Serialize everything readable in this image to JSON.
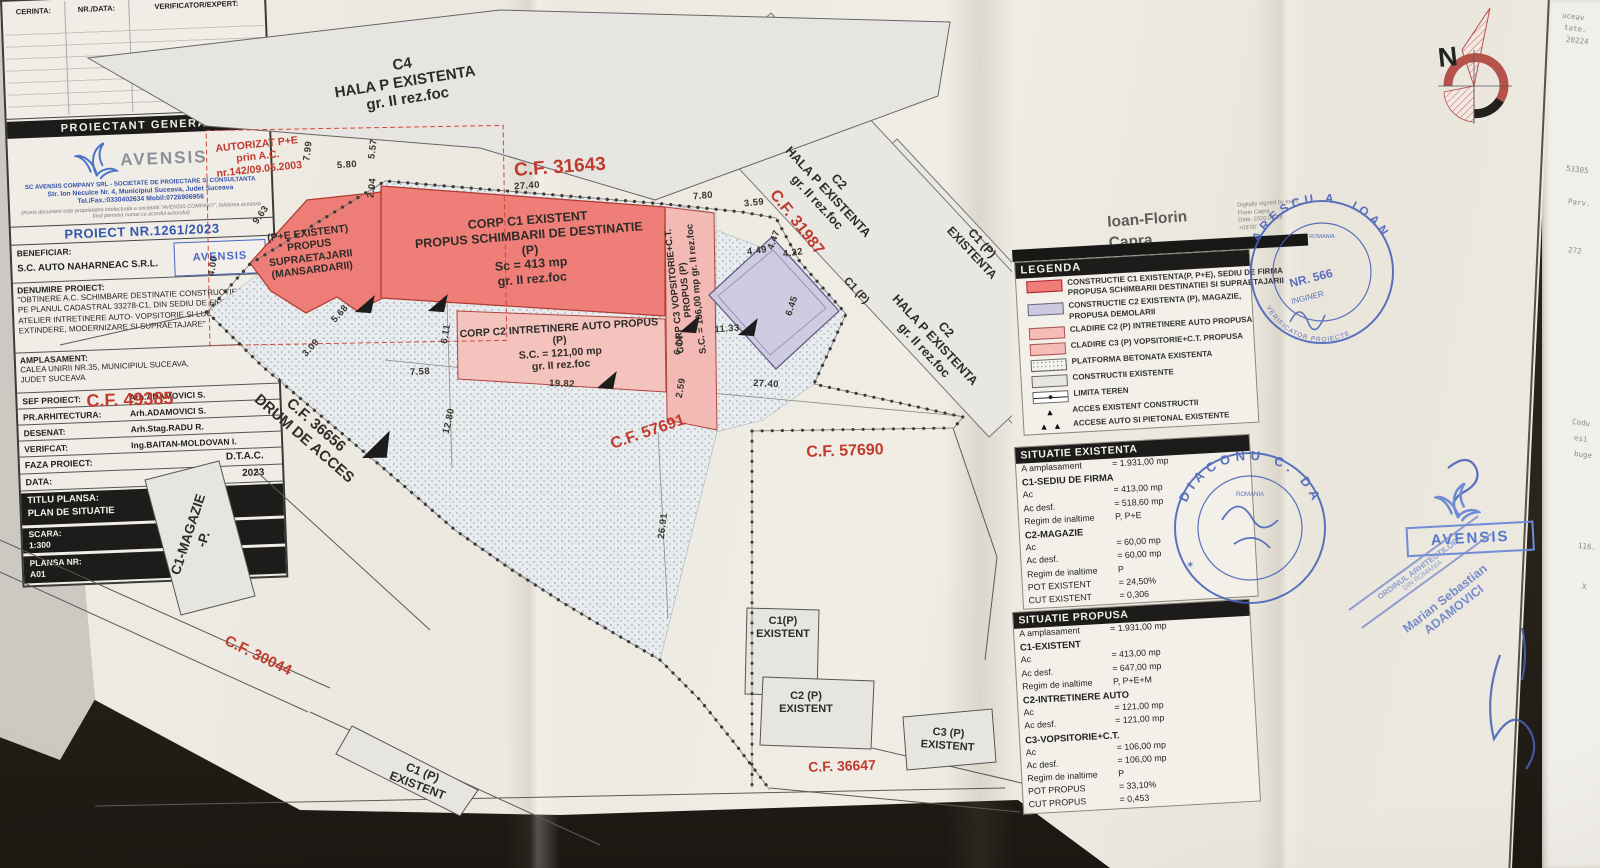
{
  "colors": {
    "red-fill": "#ef7e78",
    "red-border": "#b03a30",
    "pink-fill": "#f5bdb8",
    "lavender-fill": "#ccc9e1",
    "lavender-border": "#8a84b4",
    "gray-fill": "#e9e7e2",
    "cf-red": "#c2392e",
    "stamp-blue": "#4661b8",
    "bar-black": "#1d1c1a",
    "ink": "#2e2c28"
  },
  "plan": {
    "labels": {
      "c4": "C4\nHALA P EXISTENTA\ngr. II rez.foc",
      "autorizat": "AUTORIZAT P+E\nprin A.C.\nnr.142/09.05.2003",
      "pe_existent": "(P+E EXISTENT)\nPROPUS\nSUPRAETAJARII\n(MANSARDARII)",
      "corp_c1": "CORP C1 EXISTENT\nPROPUS SCHIMBARII DE DESTINATIE\n(P)\nSc = 413 mp\ngr. II rez.foc",
      "corp_c2": "CORP C2 INTRETINERE AUTO PROPUS\n(P)\nS.C. = 121,00 mp\ngr. II rez.foc",
      "corp_c3": "CORP C3 VOPSITORIE+C.T.\nPROPUS (P)\nS.C. = 106,00 mp   gr. II rez.foc",
      "hala_c2_a": "C2\nHALA P EXISTENTA\ngr. II rez.foc",
      "hala_c2_b": "C2\nHALA P EXISTENTA\ngr. II rez.foc",
      "c1p": "C1 (P)",
      "c1p_existenta": "C1 (P)\nEXISTENTA",
      "c1_magazie": "C1-MAGAZIE\n-P.",
      "c1p_existent_rot": "C1 (P)\nEXISTENT",
      "c1p_existent_box": "C1(P)\nEXISTENT",
      "c2p_existent_box": "C2 (P)\nEXISTENT",
      "c3p_existent_box": "C3 (P)\nEXISTENT"
    },
    "cf": {
      "cf31643": "C.F. 31643",
      "cf31987": "C.F. 31987",
      "cf49385": "C.F. 49385",
      "drum": "C.F. 36656\nDRUM DE ACCES",
      "cf57691": "C.F. 57691",
      "cf57690": "C.F. 57690",
      "cf30044": "C.F. 30044",
      "cf36647": "C.F. 36647"
    },
    "dims": [
      "7.99",
      "5.57",
      "5.80",
      "2.04",
      "9.63",
      "4.00",
      "5.68",
      "3.09",
      "7.58",
      "6.11",
      "12.80",
      "19.82",
      "27.40",
      "7.80",
      "3.59",
      "4.49",
      "4.47",
      "4.22",
      "6.45",
      "11.33",
      "6.14",
      "2.59",
      "27.40",
      "26.91"
    ]
  },
  "north_letter": "N",
  "signature": {
    "name": "Ioan-Florin\nCapra",
    "digital": "Digitally signed by Ioan-\nFlorin Capra\nDate: 2020.07.28\n+03'00'"
  },
  "legend": {
    "title": "LEGENDA",
    "items": [
      {
        "swatch": "red",
        "text": "CONSTRUCTIE C1 EXISTENTA(P, P+E), SEDIU DE FIRMA\nPROPUSA SCHIMBARII DESTINATIEI SI SUPRAETAJARII"
      },
      {
        "swatch": "lavender",
        "text": "CONSTRUCTIE C2 EXISTENTA (P), MAGAZIE,\nPROPUSA DEMOLARII"
      },
      {
        "swatch": "pink",
        "text": "CLADIRE C2 (P) INTRETINERE AUTO PROPUSA"
      },
      {
        "swatch": "pink",
        "text": "CLADIRE C3 (P) VOPSITORIE+C.T. PROPUSA"
      },
      {
        "swatch": "hatch",
        "text": "PLATFORMA BETONATA EXISTENTA"
      },
      {
        "swatch": "gray",
        "text": "CONSTRUCTII EXISTENTE"
      },
      {
        "swatch": "limit-line",
        "text": "LIMITA TEREN"
      },
      {
        "swatch": "triangle",
        "icon": "▲",
        "text": "ACCES EXISTENT CONSTRUCTII"
      },
      {
        "swatch": "double-triangle",
        "icon": "▲ ▲",
        "text": "ACCESE AUTO SI PIETONAL EXISTENTE"
      }
    ]
  },
  "situatie_existenta": {
    "title": "SITUATIE EXISTENTA",
    "rows": [
      {
        "l": "A amplasament",
        "v": "= 1.931,00 mp"
      },
      {
        "l": "C1-SEDIU DE FIRMA",
        "v": ""
      },
      {
        "l": "Ac",
        "v": "=   413,00 mp"
      },
      {
        "l": "Ac desf.",
        "v": "=   518,60 mp"
      },
      {
        "l": "Regim de inaltime",
        "v": "P, P+E"
      },
      {
        "l": "C2-MAGAZIE",
        "v": ""
      },
      {
        "l": "Ac",
        "v": "=     60,00 mp"
      },
      {
        "l": "Ac desf.",
        "v": "=     60,00 mp"
      },
      {
        "l": "Regim de inaltime",
        "v": "P"
      },
      {
        "l": "POT EXISTENT",
        "v": "= 24,50%"
      },
      {
        "l": "CUT EXISTENT",
        "v": "= 0,306"
      }
    ]
  },
  "situatie_propusa": {
    "title": "SITUATIE PROPUSA",
    "rows": [
      {
        "l": "A amplasament",
        "v": "= 1.931,00 mp"
      },
      {
        "l": "C1-EXISTENT",
        "v": ""
      },
      {
        "l": "Ac",
        "v": "=   413,00 mp"
      },
      {
        "l": "Ac desf.",
        "v": "=   647,00 mp"
      },
      {
        "l": "Regim de inaltime",
        "v": "P, P+E+M"
      },
      {
        "l": "C2-INTRETINERE AUTO",
        "v": ""
      },
      {
        "l": "Ac",
        "v": "=   121,00 mp"
      },
      {
        "l": "Ac desf.",
        "v": "=   121,00 mp"
      },
      {
        "l": "C3-VOPSITORIE+C.T.",
        "v": ""
      },
      {
        "l": "Ac",
        "v": "=   106,00 mp"
      },
      {
        "l": "Ac desf.",
        "v": "=   106,00 mp"
      },
      {
        "l": "Regim de inaltime",
        "v": "P"
      },
      {
        "l": "POT PROPUS",
        "v": "= 33,10%"
      },
      {
        "l": "CUT PROPUS",
        "v": "= 0,453"
      }
    ]
  },
  "title_block": {
    "header": {
      "c1": "CERINTA:",
      "c2": "NR./DATA:",
      "c3": "VERIFICATOR/EXPERT:"
    },
    "proiectant_general": "PROIECTANT GENERAL",
    "avensis": {
      "logo_text": "AVENSIS",
      "line1": "SC AVENSIS COMPANY SRL - SOCIETATE DE PROIECTARE SI CONSULTANTA",
      "line2": "Str. Ion Neculce Nr. 4, Municipiul Suceava, Judet Suceava",
      "line3": "Tel./Fax.:0330402634   Mobil:0726906956",
      "disclaimer": "(Acest document este proprietatea intelectuala a societatii \"AVENSIS COMPANY\", folosirea acestuia fiind permisa numai cu acordul autorului)"
    },
    "proiect_nr": "PROIECT NR.1261/2023",
    "beneficiar_label": "BENEFICIAR:",
    "beneficiar_value": "S.C. AUTO NAHARNEAC S.R.L.",
    "beneficiar_stamp": "AVENSIS",
    "denumire_label": "DENUMIRE PROIECT:",
    "denumire_value": "\"OBTINERE A.C. SCHIMBARE DESTINATIE CONSTRUCTIE NOTATA PE PLANUL CADASTRAL 33278-C1, DIN SEDIU DE FIRMA IN ATELIER INTRETINERE AUTO- VOPSITORIE SI LUCRARI DE EXTINDERE, MODERNIZARE SI SUPRAETAJARE\"",
    "amplasament_label": "AMPLASAMENT:",
    "amplasament_value": "CALEA UNIRII NR.35, MUNICIPIUL SUCEAVA,\nJUDET SUCEAVA",
    "staff": [
      {
        "l": "SEF PROIECT:",
        "v": "Arh.ADAMOVICI S."
      },
      {
        "l": "PR.ARHITECTURA:",
        "v": "Arh.ADAMOVICI S."
      },
      {
        "l": "DESENAT:",
        "v": "Arh.Stag.RADU R."
      },
      {
        "l": "VERIFCAT:",
        "v": "Ing.BAITAN-MOLDOVAN I."
      }
    ],
    "faza_label": "FAZA PROIECT:",
    "faza_value": "D.T.A.C.",
    "data_label": "DATA:",
    "data_value": "2023",
    "titlu_label": "TITLU PLANSA:",
    "titlu_value": "PLAN DE SITUATIE",
    "scara_label": "SCARA:",
    "scara_value": "1:300",
    "plansa_label": "PLANSA NR:",
    "plansa_value": "A01"
  },
  "stamps": {
    "verificator": {
      "arc": "ARESCU A. IOAN",
      "nr": "NR. 566",
      "inginer": "INGINER",
      "bottom": "VERIFICATOR PROIECTE",
      "romania": "ROMANIA"
    },
    "diaconu": {
      "arc": "DIACONU C. DA",
      "romania": "ROMANIA",
      "star": "✶"
    },
    "oar": {
      "l1": "ORDINUL ARHITECTILOR",
      "l2": "DIN ROMANIA"
    },
    "adamovici_name": "Marian Sebastian\nADAMOVICI",
    "avensis_big": "AVENSIS"
  },
  "edge_fragments": [
    "uceav",
    "tate.",
    "20224",
    "53305",
    "Parv.",
    "272",
    "Codu",
    "esi",
    "buge",
    "116.",
    "X"
  ]
}
